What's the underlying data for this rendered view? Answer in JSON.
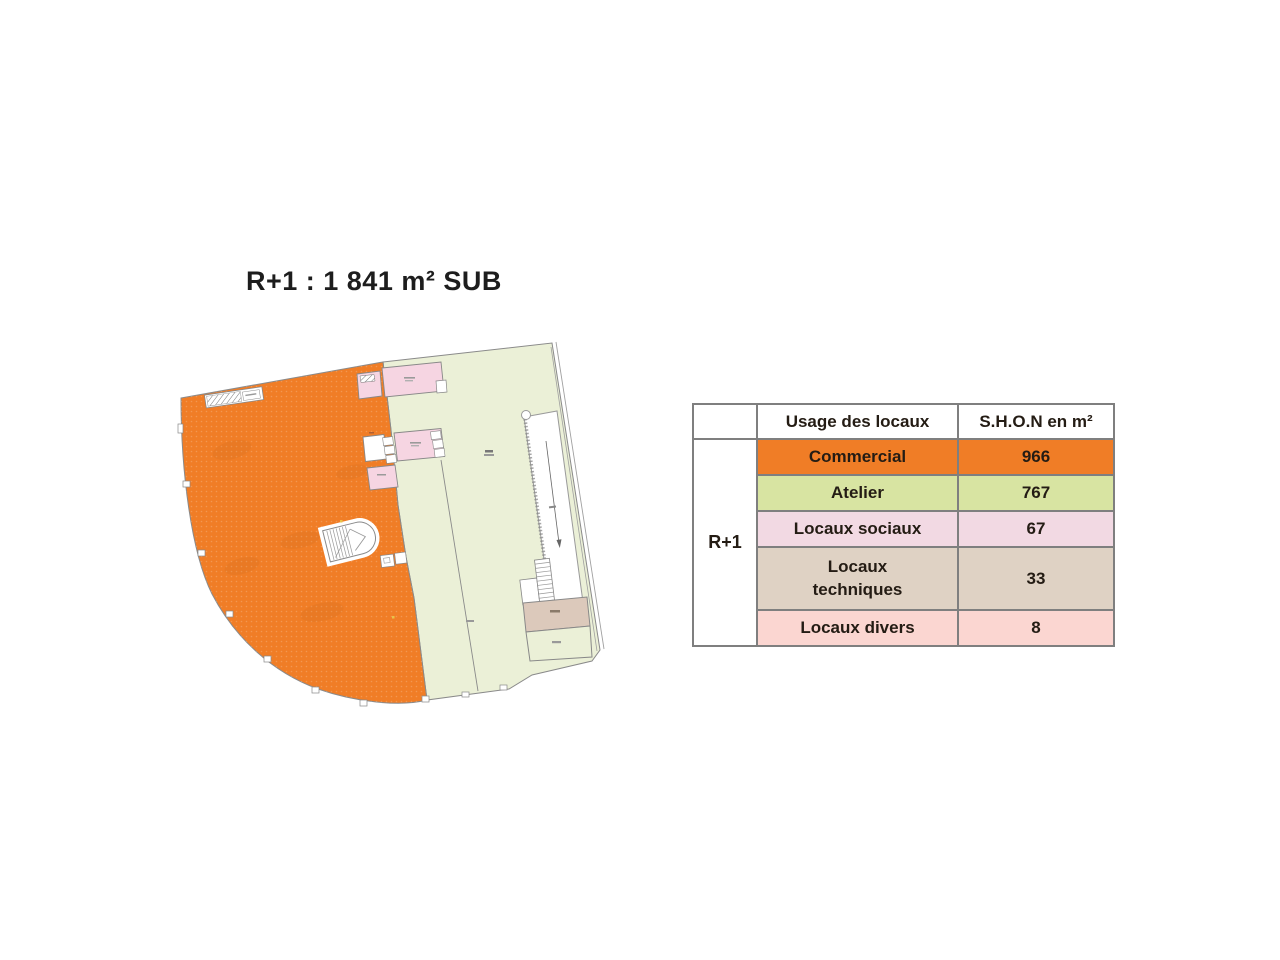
{
  "title": "R+1 : 1 841 m² SUB",
  "table": {
    "row_group_label": "R+1",
    "headers": {
      "usage": "Usage des locaux",
      "shon": "S.H.O.N en m²"
    },
    "rows": [
      {
        "label": "Commercial",
        "value": "966",
        "color": "#F07D26"
      },
      {
        "label": "Atelier",
        "value": "767",
        "color": "#D8E4A2"
      },
      {
        "label": "Locaux sociaux",
        "value": "67",
        "color": "#F2D9E3"
      },
      {
        "label": "Locaux techniques",
        "value": "33",
        "color": "#DFD2C4"
      },
      {
        "label": "Locaux divers",
        "value": "8",
        "color": "#FBD6D1"
      }
    ]
  },
  "plan": {
    "regions": {
      "commercial": "#F07D26",
      "atelier": "#EBF0D7",
      "locaux_sociaux": "#F6D5E2",
      "locaux_techniques": "#DCC9BB",
      "wall": "#8A8A8A"
    }
  }
}
